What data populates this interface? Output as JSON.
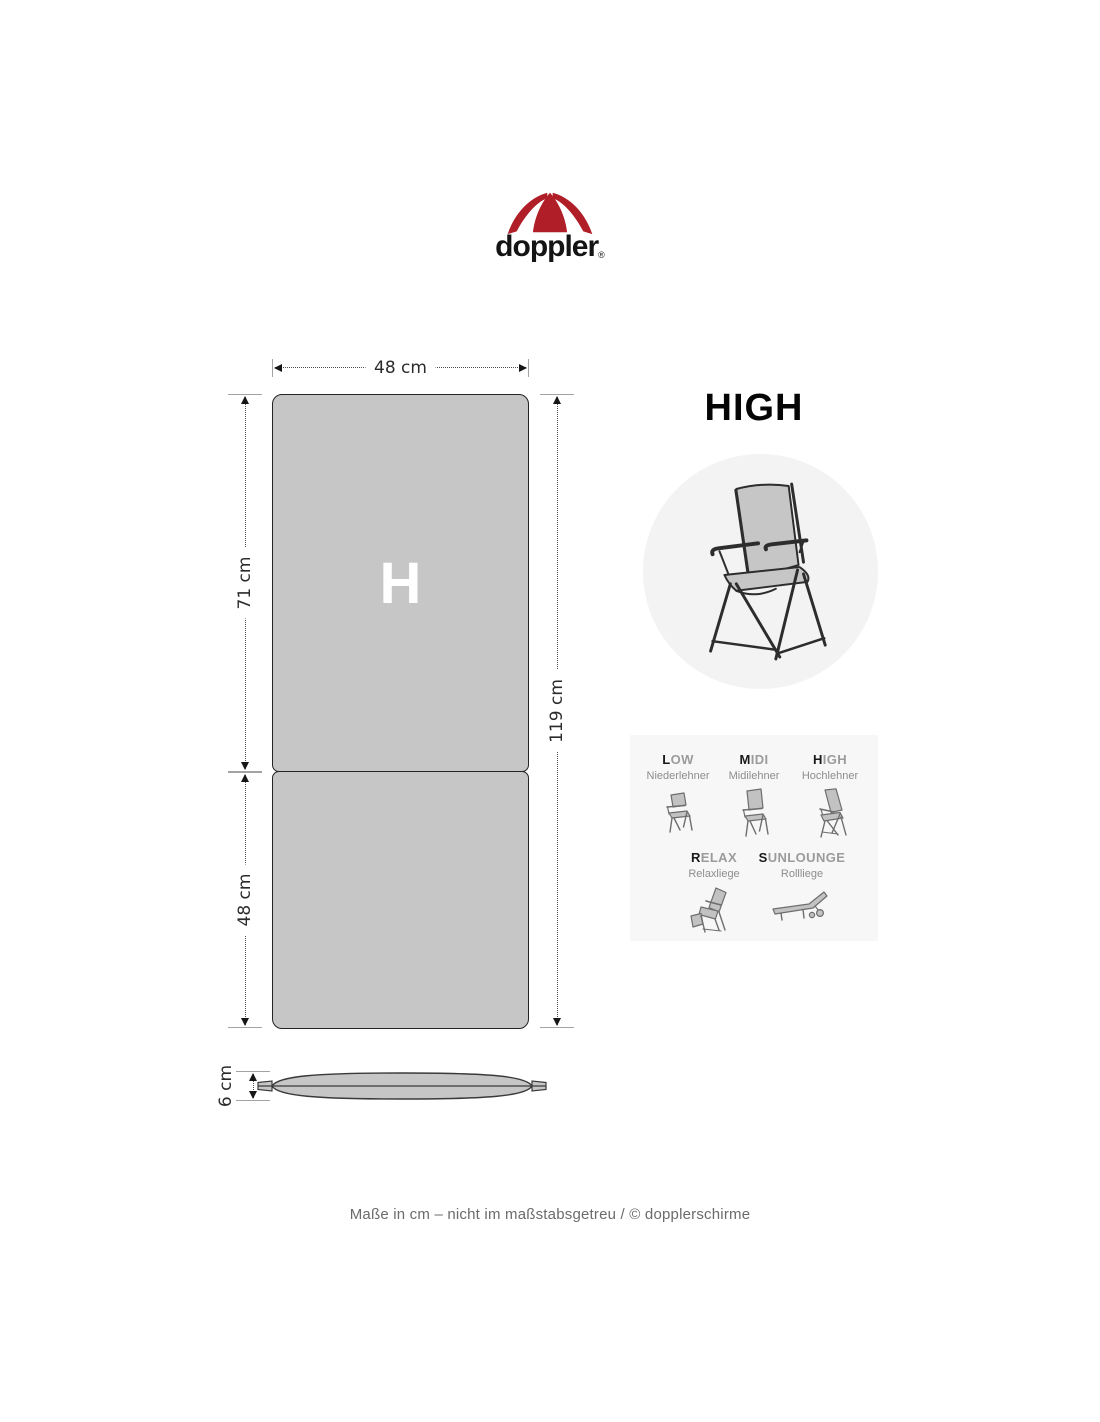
{
  "logo": {
    "brand": "doppler",
    "trademark": "®"
  },
  "diagram": {
    "cushion_letter": "H",
    "dimensions": {
      "width": "48 cm",
      "back_height": "71 cm",
      "seat_height": "48 cm",
      "total_height": "119 cm",
      "thickness": "6 cm"
    }
  },
  "type_card": {
    "title": "HIGH",
    "types": [
      {
        "first": "L",
        "rest": "OW",
        "subtitle": "Niederlehner"
      },
      {
        "first": "M",
        "rest": "IDI",
        "subtitle": "Midilehner"
      },
      {
        "first": "H",
        "rest": "IGH",
        "subtitle": "Hochlehner"
      },
      {
        "first": "R",
        "rest": "ELAX",
        "subtitle": "Relaxliege"
      },
      {
        "first": "S",
        "rest": "UNLOUNGE",
        "subtitle": "Rollliege"
      }
    ]
  },
  "footer": {
    "note": "Maße in cm – nicht im maßstabsgetreu  / © dopplerschirme"
  },
  "colors": {
    "brand_red": "#b01e28",
    "cushion_gray": "#c6c6c6",
    "circle_gray": "#f3f3f3",
    "panel_gray": "#f7f7f7"
  },
  "icons": {
    "umbrella-icon": "red doppler umbrella mark",
    "high-back-chair-icon": "folding high-back garden chair",
    "low-chair-icon": "low back chair",
    "midi-chair-icon": "midi back chair",
    "high-chair-icon": "high back recliner chair",
    "relax-chair-icon": "relax recliner with footrest",
    "sunlounge-chair-icon": "rolling sun lounger",
    "cushion-side-view": "cushion thickness profile"
  }
}
